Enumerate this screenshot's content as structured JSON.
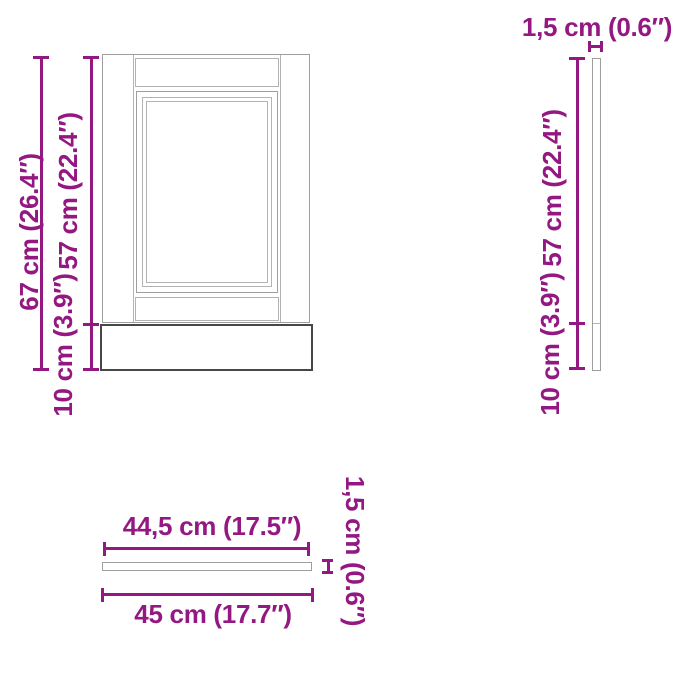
{
  "colors": {
    "dimension_text": "#941882",
    "panel_outline": "#9e9e9e",
    "panel_detail": "#b3b3b3",
    "plinth_outline": "#474747",
    "background": "#ffffff"
  },
  "front_view": {
    "total_height_label": "67 cm (26.4″)",
    "door_height_label": "57 cm (22.4″)",
    "plinth_height_label": "10 cm (3.9″)"
  },
  "side_view": {
    "thickness_label": "1,5 cm (0.6″)",
    "door_height_label": "57 cm (22.4″)",
    "plinth_height_label": "10 cm (3.9″)"
  },
  "top_view": {
    "door_width_label": "44,5 cm (17.5″)",
    "total_width_label": "45 cm (17.7″)",
    "thickness_label": "1,5 cm (0.6″)"
  }
}
